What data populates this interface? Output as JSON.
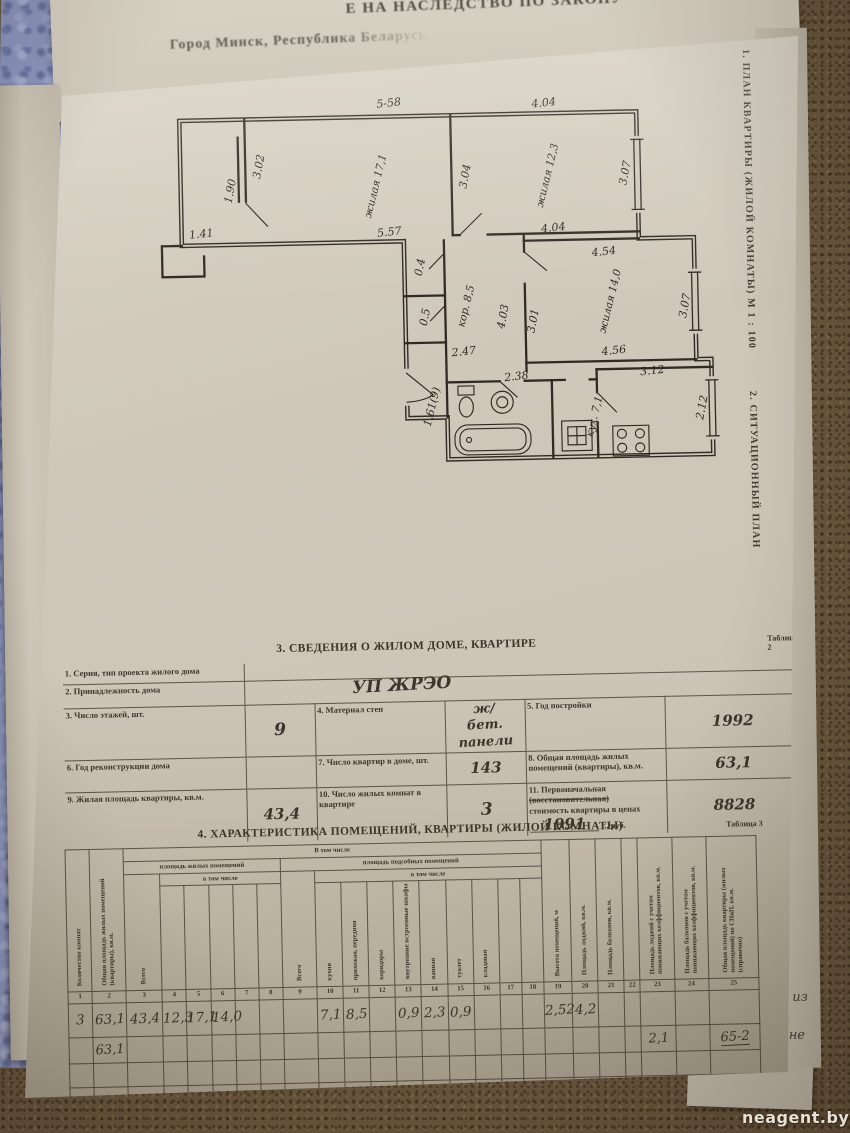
{
  "scene": {
    "watermark": "neagent.by"
  },
  "top_page": {
    "line1": "Е НА НАСЛЕДСТВО ПО ЗАКОНУ",
    "line2": "Город Минск, Республика Беларусь, Ш"
  },
  "fragments": {
    "f1": "ь",
    "f2": "из",
    "f3": "не"
  },
  "side_captions": {
    "plan": "1. ПЛАН КВАРТИРЫ (ЖИЛОЙ КОМНАТЫ) М 1 : 100",
    "situation": "2. СИТУАЦИОННЫЙ ПЛАН"
  },
  "floor_plan": {
    "labels": [
      "5-58",
      "4.04",
      "3.02",
      "1.90",
      "жилая 17,1",
      "3.04",
      "жилая 12,3",
      "3.07",
      "1.41",
      "5.57",
      "4.04",
      "4.54",
      "0.4",
      "0.5",
      "кор. 8,5",
      "жилая 14,0",
      "3.07",
      "4.03",
      "3.01",
      "2.47",
      "4.56",
      "2.38",
      "3.12",
      "1.61(9)",
      "кух. 7,1",
      "2.12"
    ]
  },
  "table2": {
    "title": "3. СВЕДЕНИЯ О ЖИЛОМ ДОМЕ, КВАРТИРЕ",
    "tag": "Таблица 2",
    "r1_label": "1. Серия, тип проекта жилого дома",
    "r2_label": "2. Принадлежность  дома",
    "r2_value": "УП  ЖРЭО",
    "r3_l1": "3. Число этажей, шт.",
    "r3_v1": "9",
    "r3_l2": "4. Материал стен",
    "r3_v2": "ж/бет. панели",
    "r3_l3": "5. Год постройки",
    "r3_v3": "1992",
    "r4_l1": "6. Год реконструкции дома",
    "r4_l2": "7. Число квартир в доме, шт.",
    "r4_v2": "143",
    "r4_l3": "8. Общая площадь жилых помещений (квартиры), кв.м.",
    "r4_v3": "63,1",
    "r5_l1": "9. Жилая площадь квартиры, кв.м.",
    "r5_v1": "43,4",
    "r5_l2": "10. Число жилых комнат в квартире",
    "r5_v2": "3",
    "r5_l3_a": "11. Первоначальная",
    "r5_l3_strike": "(восстановительная)",
    "r5_l3_b": "стоимость квартиры в ценах",
    "r5_l3_year": "1991",
    "r5_l3_c": "г., руб.",
    "r5_v3": "8828"
  },
  "table3": {
    "title": "4. ХАРАКТЕРИСТИКА ПОМЕЩЕНИЙ, КВАРТИРЫ (ЖИЛОЙ КОМНАТЫ)",
    "tag": "Таблица 3",
    "groups": {
      "incl_top": "В том числе",
      "living": "площадь жилых помещений",
      "aux": "площадь подсобных  помещений",
      "incl_sub": "в том числе",
      "total": "Всего"
    },
    "cols": {
      "c1": "Количество комнат",
      "c2": "Общая площадь жилых помещений (квартиры), кв.м.",
      "c10": "кухня",
      "c11": "прихожая, передняя",
      "c12": "коридоры",
      "c13": "внутренние встроенные шкафы",
      "c14": "ванная",
      "c15": "туалет",
      "c16": "кладовая",
      "c19": "Высота помещений, м",
      "c20": "Площадь лоджий, кв.м.",
      "c21": "Площадь балконов, кв.м.",
      "c23": "Площадь лоджий с учетом понижающих коэффициентов, кв.м.",
      "c24": "Площадь балконов с учетом понижающих коэффициентов, кв.м.",
      "c25": "Общая площадь квартиры (жилых помещений) по СНиП, кв.м. (справочно)"
    },
    "numbers": [
      "1",
      "2",
      "3",
      "4",
      "5",
      "6",
      "7",
      "8",
      "9",
      "10",
      "11",
      "12",
      "13",
      "14",
      "15",
      "16",
      "17",
      "18",
      "19",
      "20",
      "21",
      "22",
      "23",
      "24",
      "25"
    ],
    "row1": {
      "c1": "3",
      "c2": "63,1",
      "c3": "43,4",
      "c4": "12,3",
      "c5": "17,1",
      "c6": "14,0",
      "c10": "7,1",
      "c11": "8,5",
      "c13": "0,9",
      "c14": "2,3",
      "c15": "0,9",
      "c19": "2,52",
      "c20": "4,2"
    },
    "row2": {
      "c2": "63,1",
      "c23": "2,1",
      "c25": "65-2"
    }
  }
}
